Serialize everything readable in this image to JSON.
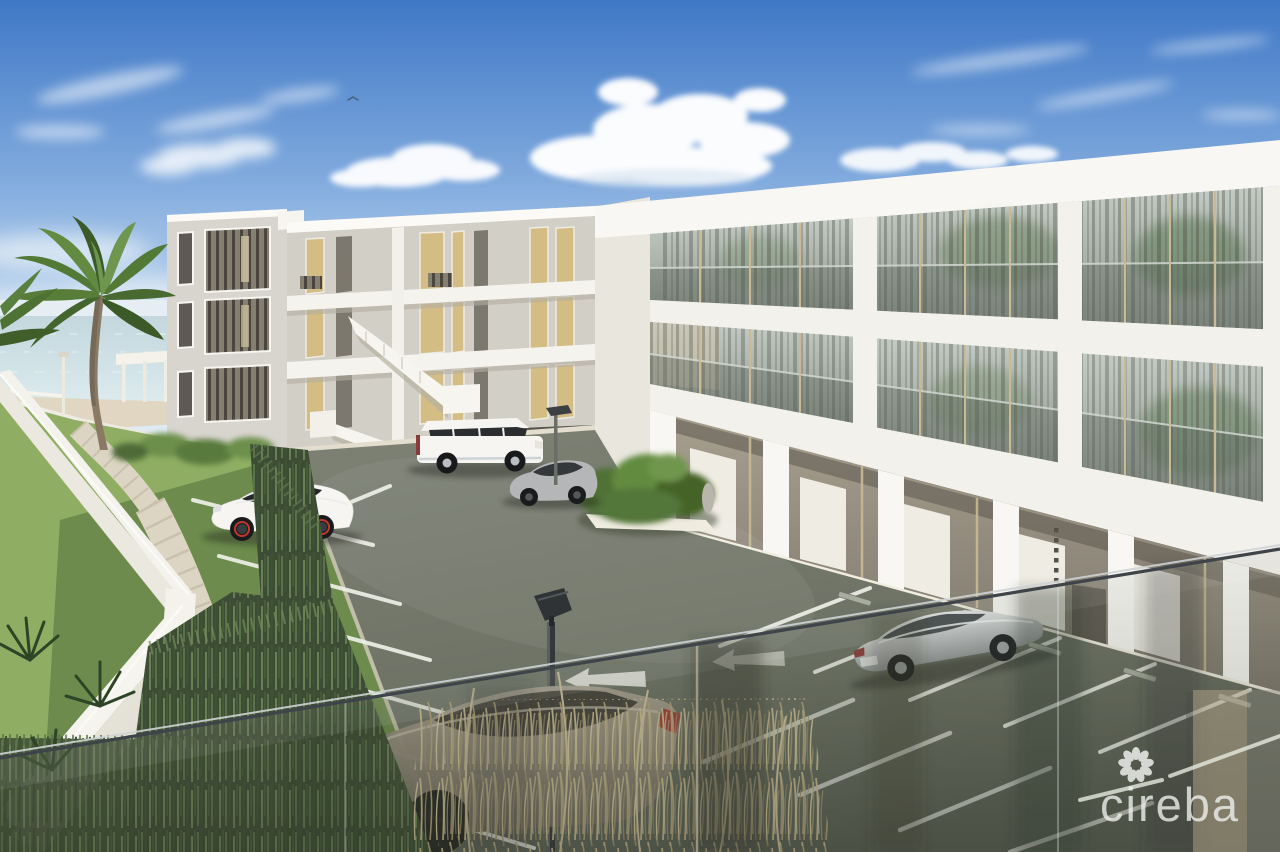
{
  "scene": {
    "type": "architectural-rendering",
    "description": "3D rendering of a white three-storey beachfront condominium complex with landscaped parking lot, palm tree, perimeter wall and sea glimpse, viewed from an elevated balcony behind a glass railing",
    "watermark": {
      "brand": "cireba"
    },
    "buildings": [
      {
        "name": "left-wing",
        "storeys": 3,
        "features": "external zig-zag staircase, gold curtained windows, white balconies"
      },
      {
        "name": "right-wing",
        "storeys": 3,
        "features": "full-height glass bays with tan mullions, glass balustrades, ground-floor arcade"
      }
    ],
    "vehicles": [
      {
        "name": "white-crossover",
        "color": "white",
        "location": "left parking row"
      },
      {
        "name": "white-fullsize-suv",
        "color": "white",
        "location": "upper row by left wing"
      },
      {
        "name": "grey-compact-suv",
        "color": "grey",
        "location": "beside planter"
      },
      {
        "name": "silver-sedan",
        "color": "silver",
        "location": "right row by arcade"
      },
      {
        "name": "beige-suv-foreground",
        "color": "beige-grey",
        "location": "foreground behind glass railing"
      }
    ],
    "landscape": [
      "palm tree",
      "sea horizon",
      "white perimeter wall",
      "stone footpath",
      "reed hedge",
      "dry grasses",
      "planter shrubs"
    ]
  },
  "palette": {
    "sky_top": "#3f78c6",
    "sky_mid": "#7fa9dd",
    "sky_low": "#c6dcf0",
    "sky_horizon": "#e8f1f7",
    "sea": "#c3d7dd",
    "sand": "#e0d6c2",
    "bldg_white": "#f3f1ec",
    "bldg_fascia": "#f8f7f3",
    "bldg_shade": "#d8d5ce",
    "bldg_warmgray": "#d2cfc7",
    "slab_shadow": "#b2ada0",
    "glass_lt": "#c2cbc4",
    "glass_dk": "#8e968c",
    "frame_tan": "#c9ba93",
    "curtain_gold": "#d3bd85",
    "asphalt_lt": "#7d8174",
    "asphalt_dk": "#5a5f53",
    "line_white": "#eef0e8",
    "grass_lt": "#8fae63",
    "grass_dk": "#51703b",
    "hedge_dark": "#3d4c34",
    "reed_1": "#5c744a",
    "reed_2": "#71895a",
    "path_stone": "#dcd5c3",
    "wall_white": "#f4f2ec",
    "palm_green": "#527a36",
    "palm_dark": "#3c5a28",
    "trunk": "#8a7a64",
    "lamp_dark": "#34383b",
    "rail_dark": "#3e4449",
    "rail_light": "#cfd3d6",
    "glass_streak": "#2f352b",
    "wm_white": "#f2f4f1",
    "car_white": "#f6f5f2",
    "car_silver": "#c0c3c4",
    "car_gray": "#b4b6b7",
    "car_beige": "#988f7e",
    "brake_red": "#c0392b",
    "tail_red": "#8a3a38"
  }
}
